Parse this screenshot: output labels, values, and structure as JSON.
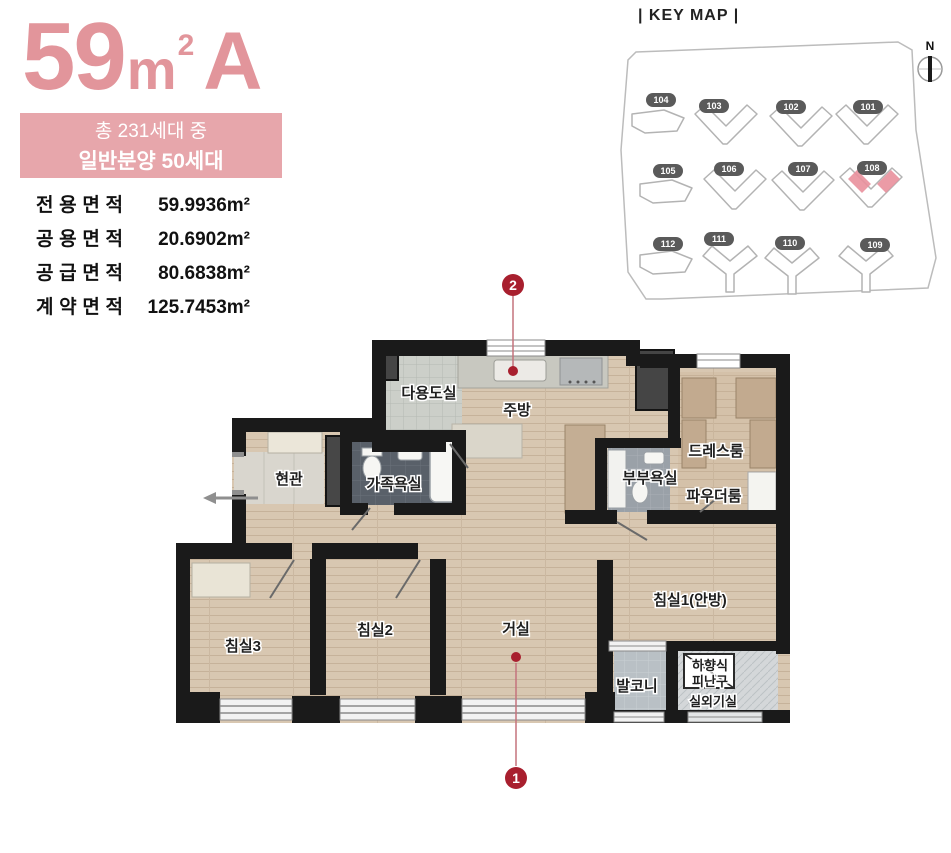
{
  "unit": {
    "number": "59",
    "unit_m": "m",
    "unit_sup": "2",
    "variant": "A"
  },
  "badge": {
    "line1": "총 231세대 중",
    "line2": "일반분양 50세대"
  },
  "areas": {
    "rows": [
      {
        "label": "전용면적",
        "value": "59.9936m²"
      },
      {
        "label": "공용면적",
        "value": "20.6902m²"
      },
      {
        "label": "공급면적",
        "value": "80.6838m²"
      },
      {
        "label": "계약면적",
        "value": "125.7453m²"
      }
    ]
  },
  "keymap": {
    "title": "| KEY MAP |",
    "compass": "N",
    "highlighted_building": "108",
    "buildings": [
      {
        "id": "104"
      },
      {
        "id": "103"
      },
      {
        "id": "102"
      },
      {
        "id": "101"
      },
      {
        "id": "105"
      },
      {
        "id": "106"
      },
      {
        "id": "107"
      },
      {
        "id": "108"
      },
      {
        "id": "112"
      },
      {
        "id": "111"
      },
      {
        "id": "110"
      },
      {
        "id": "109"
      }
    ]
  },
  "floorplan": {
    "rooms": [
      {
        "label": "다용도실"
      },
      {
        "label": "주방"
      },
      {
        "label": "드레스룸"
      },
      {
        "label": "현관"
      },
      {
        "label": "가족욕실"
      },
      {
        "label": "부부욕실"
      },
      {
        "label": "파우더룸"
      },
      {
        "label": "침실1(안방)"
      },
      {
        "label": "침실3"
      },
      {
        "label": "침실2"
      },
      {
        "label": "거실"
      },
      {
        "label": "발코니"
      },
      {
        "label": "하향식"
      },
      {
        "label": "피난구"
      },
      {
        "label": "실외기실"
      }
    ],
    "markers": [
      {
        "num": "1"
      },
      {
        "num": "2"
      }
    ]
  },
  "colors": {
    "accent_pink": "#e2959b",
    "badge_bg": "#e7a6ab",
    "marker_red": "#a81f2e",
    "wall_black": "#1a1a1a",
    "keymap_highlight": "#e9909c"
  }
}
